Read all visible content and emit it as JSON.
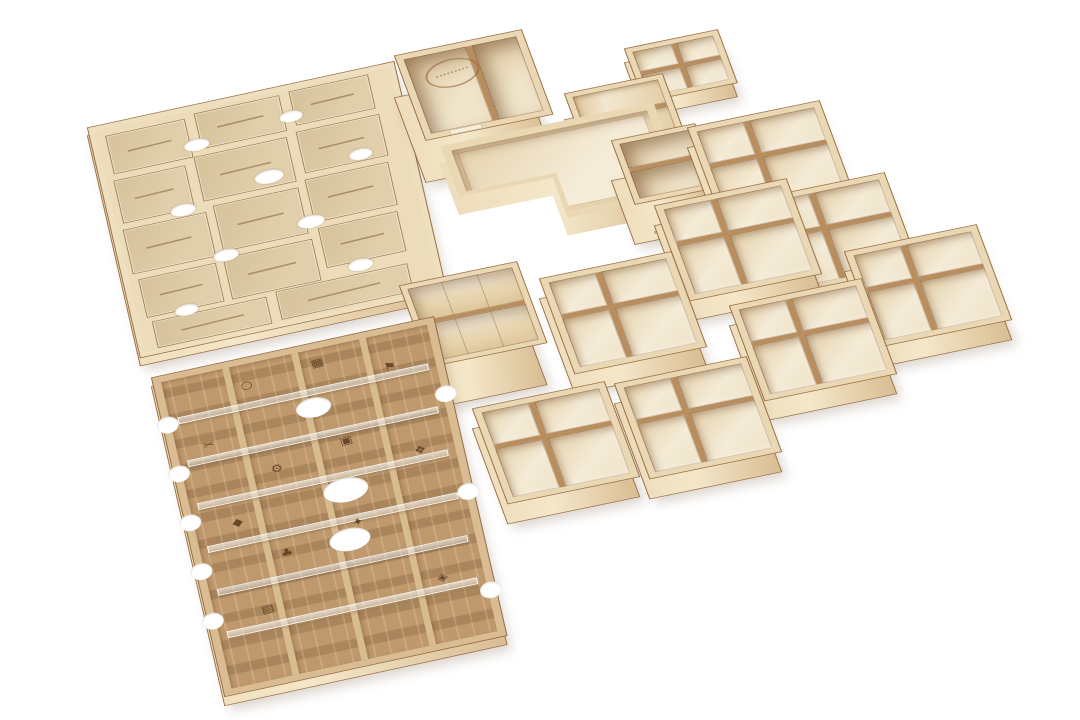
{
  "scene": {
    "type": "product-photo",
    "subject": "Laser-cut wooden board game organizer insert set, sixteen plywood pieces arranged diagonally on a white background",
    "background_color": "#ffffff",
    "piece_count": 16
  },
  "palette": {
    "plywood_rim": "#ead7b4",
    "plywood_floor": "#f4ebd6",
    "plywood_front": "#e9d6b3",
    "cut_edge": "#9a7044",
    "seam": "#b98e5f",
    "mdf_board": "#c39e73",
    "mdf_rail": "#d9bc92",
    "engraving": "#5e4023",
    "acrylic": "rgba(235,245,250,0.5)",
    "background": "#ffffff"
  },
  "pieces": [
    {
      "id": "labels-board",
      "label": "Flat board layer with engraved room compartments and illegible engraved location labels",
      "compartments": 14,
      "count": 1
    },
    {
      "id": "icons-board",
      "label": "Token slot board with engraved icons, acrylic retainer strips and finger notches",
      "lanes": 4,
      "count": 1
    },
    {
      "id": "logo-box",
      "label": "L-shaped open box with engraved oval maker logo on floor",
      "compartments": 2,
      "count": 1
    },
    {
      "id": "angled-card-tray",
      "label": "Card tray with three angled channels",
      "channels": 3,
      "count": 1
    },
    {
      "id": "small-quad-tray",
      "label": "Small four-compartment tray",
      "compartments": 4,
      "count": 1
    },
    {
      "id": "l-shaped-tray",
      "label": "L-shaped shallow tray with wide rim",
      "compartments": 1,
      "count": 1
    },
    {
      "id": "deep-card-box",
      "label": "Deep two-compartment card box with front slots",
      "compartments": 2,
      "count": 1
    },
    {
      "id": "curved-divider-box",
      "label": "Deep card box with curved scoop dividers",
      "compartments": 2,
      "count": 1
    },
    {
      "id": "quad-tray",
      "label": "Square four-compartment token tray",
      "compartments": 4,
      "count": 8
    }
  ],
  "icons_board": {
    "icons": [
      {
        "name": "ring-icon",
        "glyph": "○"
      },
      {
        "name": "grid-icon",
        "glyph": "▦"
      },
      {
        "name": "scissors-icon",
        "glyph": "✂"
      },
      {
        "name": "flag-icon",
        "glyph": "⚑"
      },
      {
        "name": "gear-icon",
        "glyph": "⚙"
      },
      {
        "name": "frame-icon",
        "glyph": "▣"
      },
      {
        "name": "gem-icon",
        "glyph": "◆"
      },
      {
        "name": "droplet-icon",
        "glyph": "❖"
      },
      {
        "name": "clover-icon",
        "glyph": "♣"
      },
      {
        "name": "spark-icon",
        "glyph": "✦"
      },
      {
        "name": "chest-icon",
        "glyph": "▤"
      },
      {
        "name": "die-icon",
        "glyph": "◈"
      }
    ]
  },
  "logo": {
    "name": "maker-logo",
    "shape": "oval-stamp",
    "legible": false
  },
  "engraving": {
    "labels_legible": false,
    "label_count": 14
  }
}
